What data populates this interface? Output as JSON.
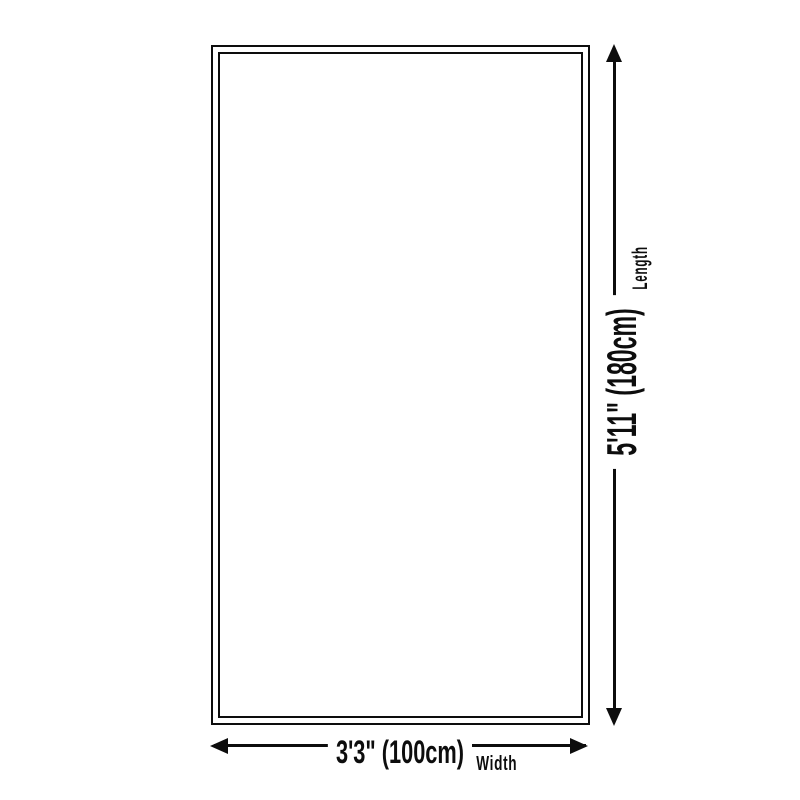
{
  "diagram": {
    "type": "product-size-diagram",
    "background_color": "#ffffff",
    "line_color": "#0d0d0d",
    "shape": "rectangle-double-border",
    "length_dimension": {
      "value_label": "5'11\" (180cm)",
      "axis_label": "Length",
      "orientation": "vertical"
    },
    "width_dimension": {
      "value_label": "3'3\" (100cm)",
      "axis_label": "Width",
      "orientation": "horizontal"
    }
  }
}
